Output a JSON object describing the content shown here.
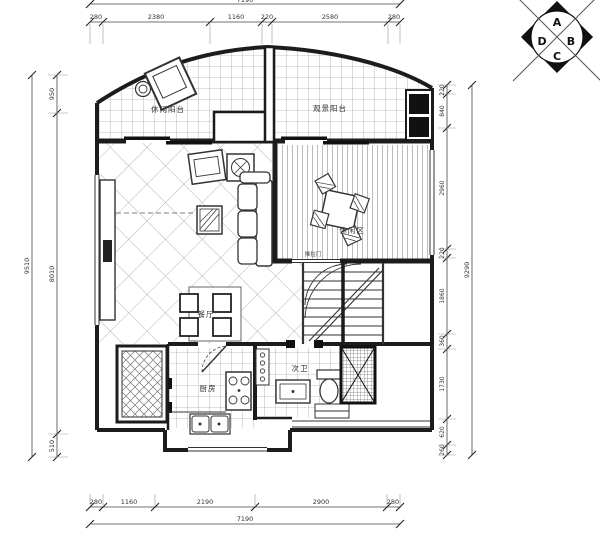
{
  "compass": {
    "a": "A",
    "b": "B",
    "c": "C",
    "d": "D"
  },
  "rooms": {
    "left_balcony": "休闲阳台",
    "right_balcony": "观景阳台",
    "leisure_area": "休闲区",
    "dining": "餐厅",
    "kitchen": "厨房",
    "bathroom": "次卫",
    "sliding_door": "推拉门"
  },
  "dims": {
    "top": {
      "total": "7190",
      "segments": [
        "280",
        "2380",
        "1160",
        "220",
        "2580",
        "280"
      ]
    },
    "bottom": {
      "total": "7190",
      "segments": [
        "280",
        "1160",
        "2190",
        "2900",
        "280"
      ]
    },
    "left": {
      "total": "9510",
      "segments": [
        "950",
        "8010",
        "510"
      ]
    },
    "right": {
      "total": "9290",
      "segments": [
        "220",
        "840",
        "2960",
        "220",
        "1860",
        "360",
        "1730",
        "620",
        "260"
      ]
    }
  }
}
